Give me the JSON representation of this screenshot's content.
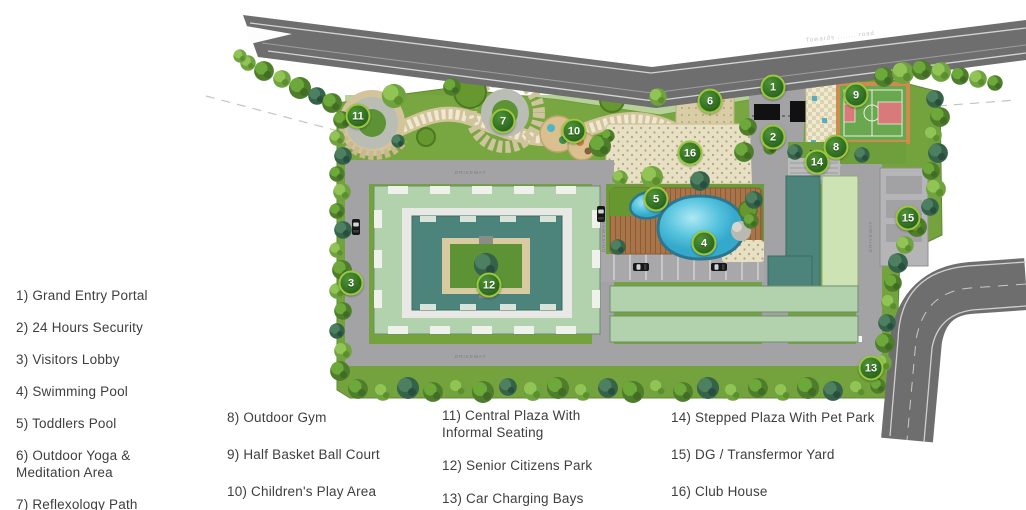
{
  "plan": {
    "road_label": "Towards ....... road",
    "driveway_label": "DRIVEWAY",
    "markers": [
      {
        "num": "1",
        "x": 773,
        "y": 87
      },
      {
        "num": "2",
        "x": 773,
        "y": 137
      },
      {
        "num": "3",
        "x": 351,
        "y": 283
      },
      {
        "num": "4",
        "x": 704,
        "y": 243
      },
      {
        "num": "5",
        "x": 656,
        "y": 199
      },
      {
        "num": "6",
        "x": 710,
        "y": 101
      },
      {
        "num": "7",
        "x": 503,
        "y": 121
      },
      {
        "num": "8",
        "x": 836,
        "y": 147
      },
      {
        "num": "9",
        "x": 856,
        "y": 95
      },
      {
        "num": "10",
        "x": 574,
        "y": 131
      },
      {
        "num": "11",
        "x": 358,
        "y": 116
      },
      {
        "num": "12",
        "x": 489,
        "y": 285
      },
      {
        "num": "13",
        "x": 871,
        "y": 368
      },
      {
        "num": "14",
        "x": 817,
        "y": 162
      },
      {
        "num": "15",
        "x": 908,
        "y": 218
      },
      {
        "num": "16",
        "x": 690,
        "y": 153
      }
    ],
    "colors": {
      "road": "#6e6e6e",
      "grass": "#74a23d",
      "driveway": "#a3a3a5",
      "building_mint": "#b2d1ad",
      "building_teal": "#4c837b",
      "pool_water": "#4bbcd9",
      "deck_wood": "#a97447",
      "court_green": "#69a84f",
      "court_red": "#d97a7a",
      "court_frame": "#cf8a4e",
      "marker_fill": "#2a661f",
      "marker_ring": "#9cc63e",
      "plaza_cream": "#e7e0c4"
    }
  },
  "legend": {
    "columns": [
      {
        "items": [
          "1) Grand Entry Portal",
          "2) 24 Hours Security",
          "3) Visitors Lobby",
          "4) Swimming Pool",
          "5) Toddlers Pool",
          "6) Outdoor Yoga & Meditation Area",
          "7) Reflexology Path"
        ]
      },
      {
        "items": [
          "8) Outdoor Gym",
          "9) Half Basket Ball Court",
          "10) Children's Play Area"
        ]
      },
      {
        "items": [
          "11) Central Plaza With Informal Seating",
          "12) Senior Citizens Park",
          "13) Car Charging Bays"
        ]
      },
      {
        "items": [
          "14) Stepped Plaza With Pet Park",
          "15) DG / Transfermor Yard",
          "16) Club House"
        ]
      }
    ]
  }
}
